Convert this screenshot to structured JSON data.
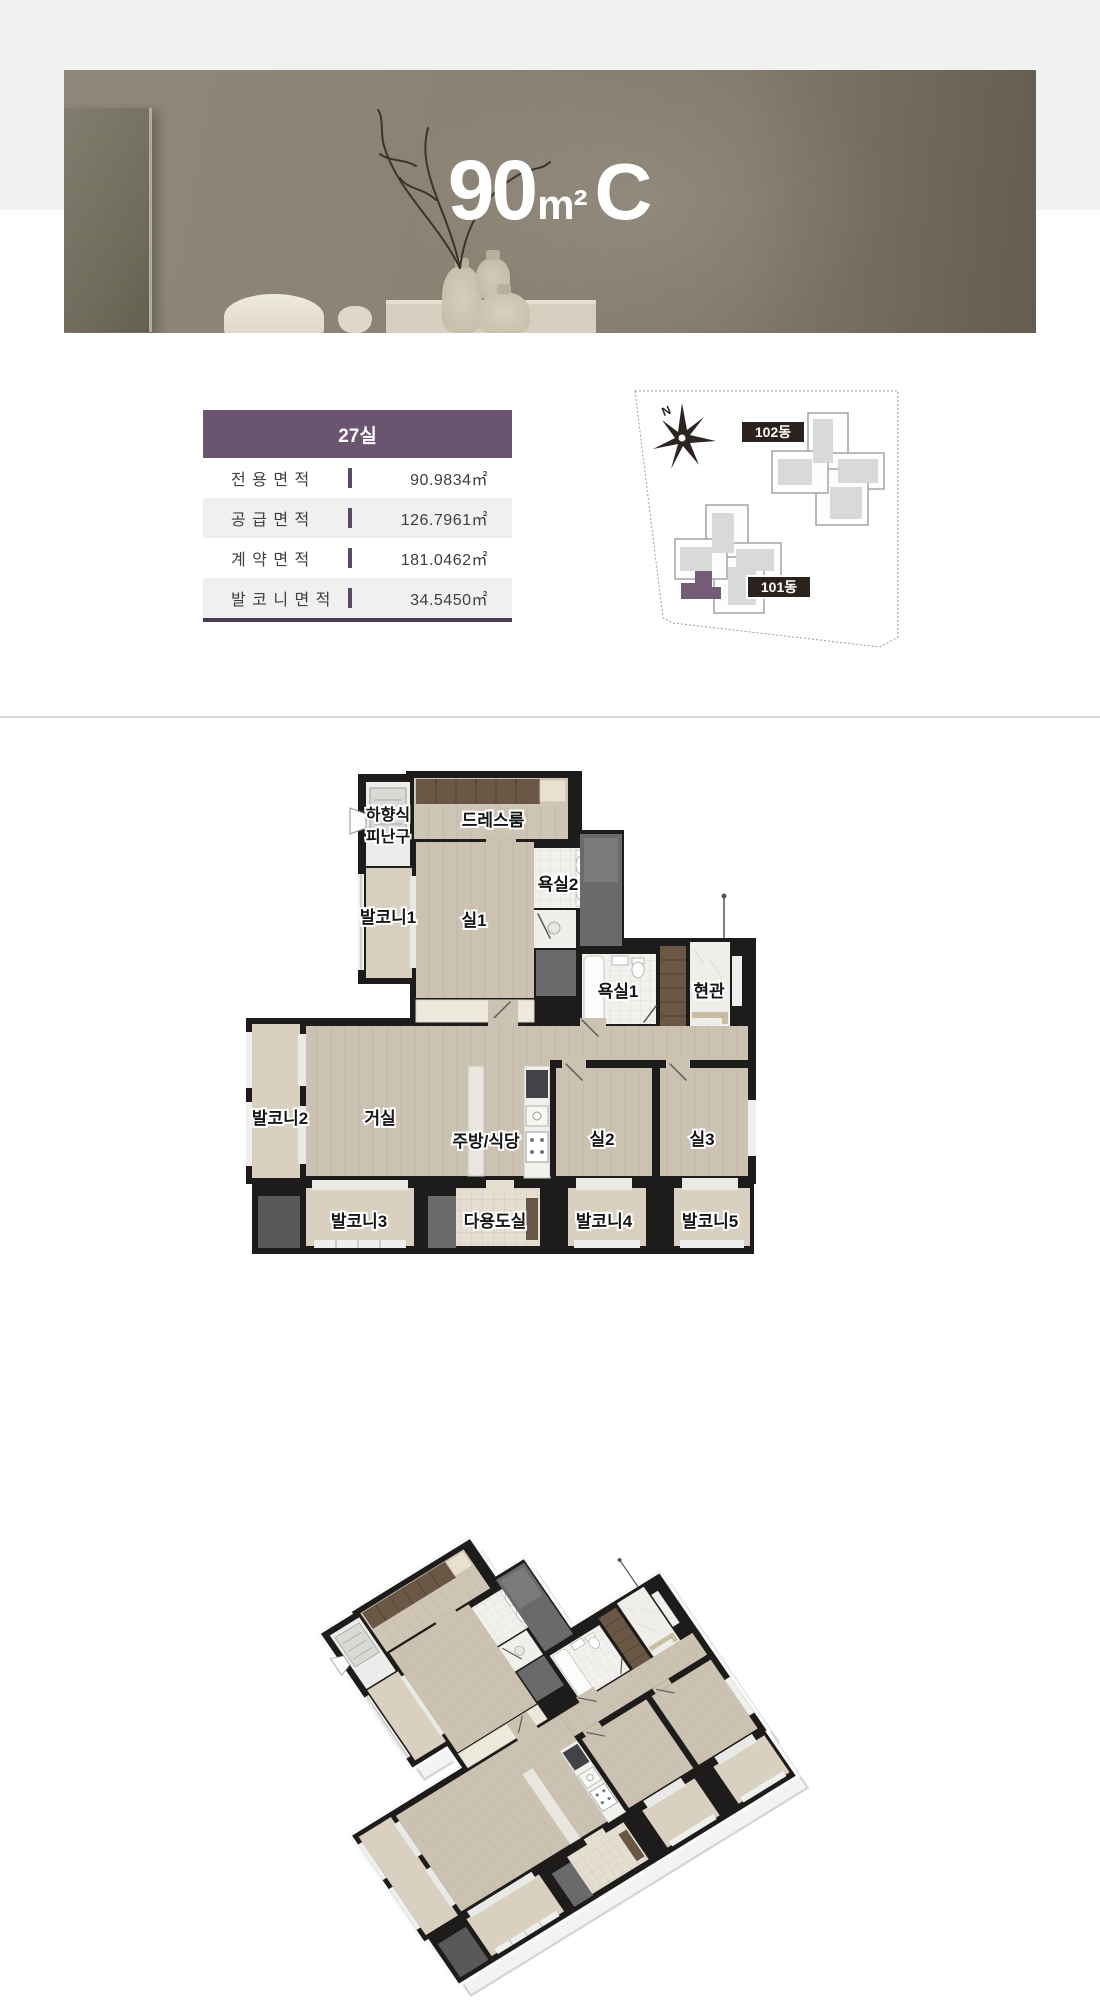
{
  "banner": {
    "area": "90",
    "unit": "m²",
    "type": "C"
  },
  "info_table": {
    "header": "27실",
    "rows": [
      {
        "label": "전 용 면 적",
        "value": "90.9834㎡"
      },
      {
        "label": "공 급 면 적",
        "value": "126.7961㎡"
      },
      {
        "label": "계 약 면 적",
        "value": "181.0462㎡"
      },
      {
        "label": "발 코 니 면 적",
        "value": "34.5450㎡"
      }
    ]
  },
  "site_plan": {
    "north_label": "N",
    "building_102": "102동",
    "building_101": "101동"
  },
  "floor_plan": {
    "labels": {
      "escape_line1": "하향식",
      "escape_line2": "피난구",
      "dress_room": "드레스룸",
      "bath2": "욕실2",
      "balcony1": "발코니1",
      "room1": "실1",
      "bath1": "욕실1",
      "entrance": "현관",
      "balcony2": "발코니2",
      "living_room": "거실",
      "kitchen_dining": "주방/식당",
      "room2": "실2",
      "room3": "실3",
      "balcony3": "발코니3",
      "utility_room": "다용도실",
      "balcony4": "발코니4",
      "balcony5": "발코니5"
    }
  },
  "colors": {
    "accent_purple": "#6a5470",
    "accent_purple_dark": "#4c3a52",
    "site_label_bg": "#2b211d",
    "floor_beige": "#ccc2b1",
    "balcony_beige": "#d9d0bf",
    "wall_black": "#1e1c1a",
    "highlight_unit": "#745c77",
    "bath_white": "#f2f1ee",
    "wood_brown": "#6b5745",
    "shaft_grey": "#6a6a6c",
    "tile_cream": "#e5dfd2",
    "row_grey": "#f0f0f0",
    "divider_grey": "#d9d9d9"
  }
}
